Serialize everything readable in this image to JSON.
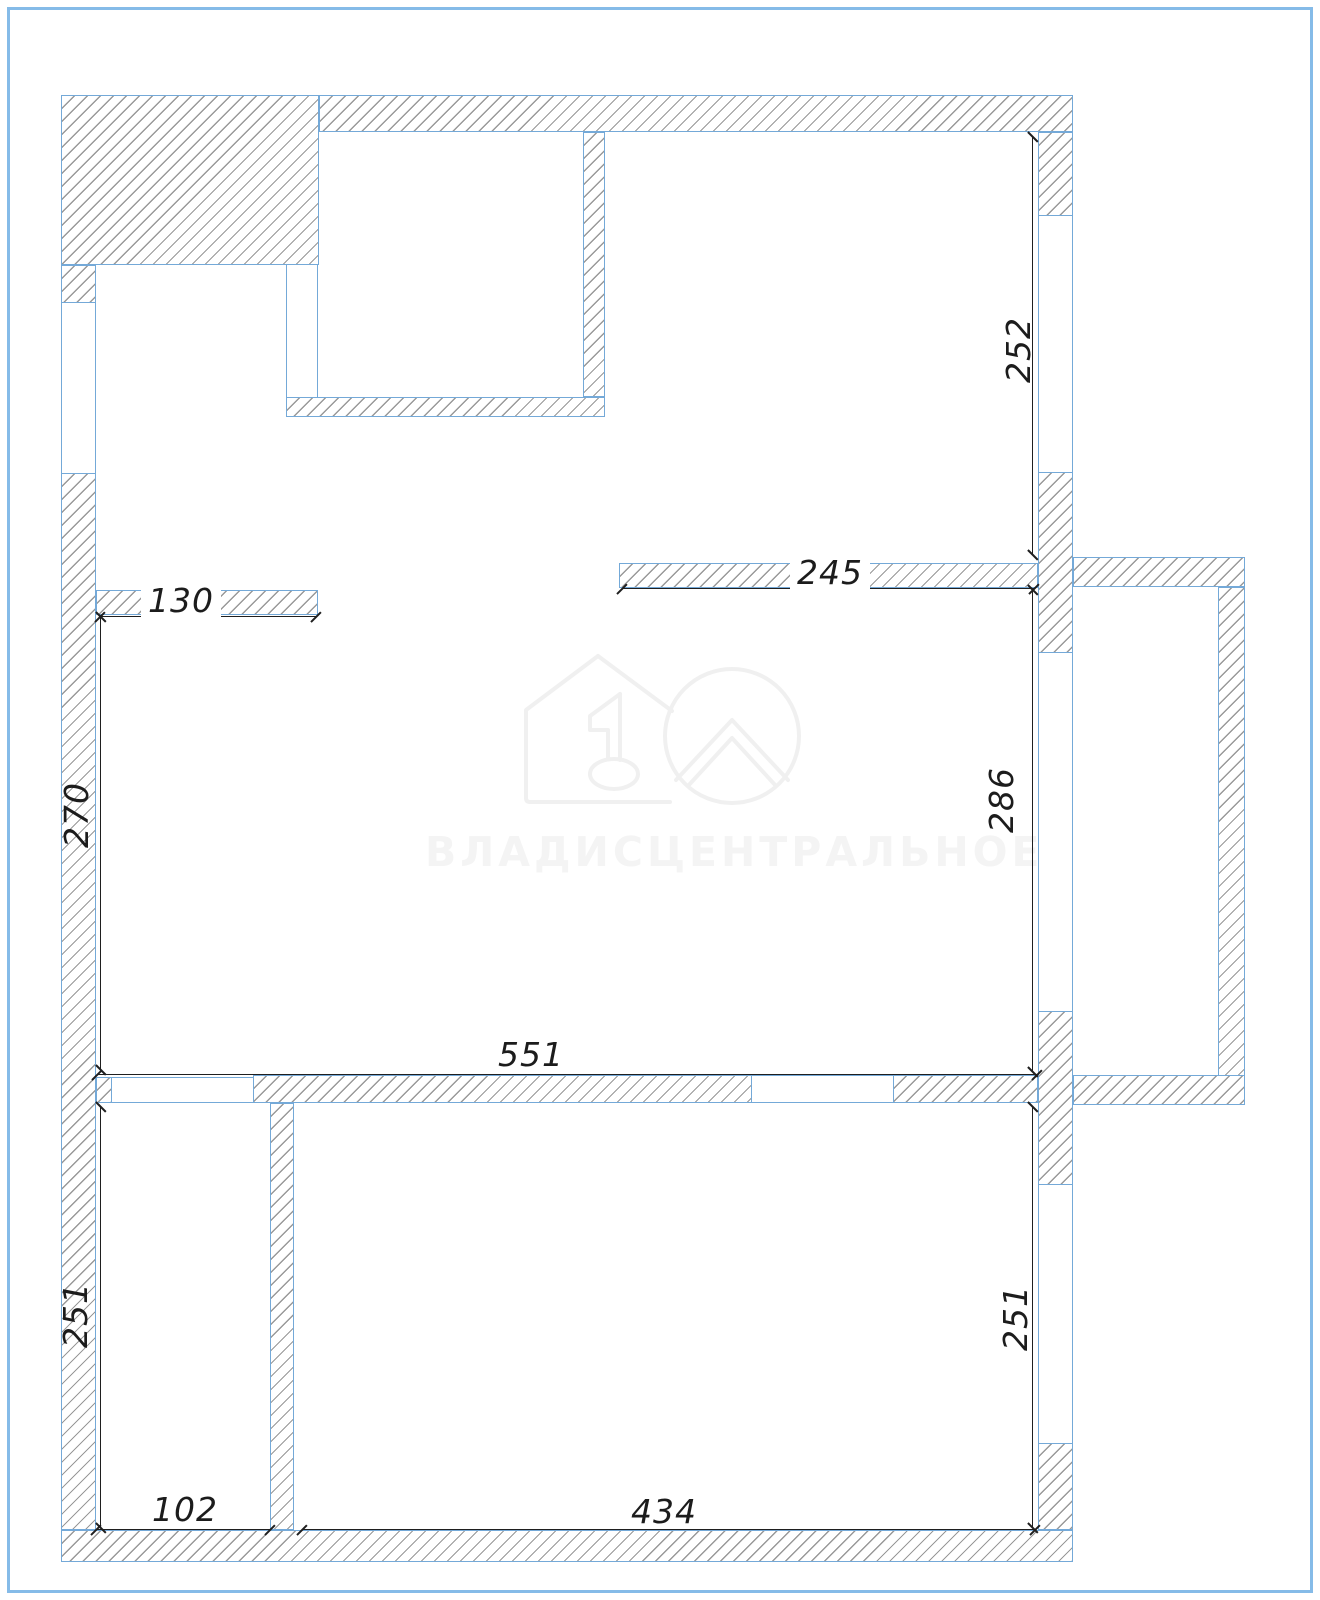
{
  "page": {
    "background": "#ffffff",
    "border_color": "#85bbe8"
  },
  "plan": {
    "type": "floor-plan",
    "wall_outline_color": "#74a9d8",
    "hatch_line_color": "#5a5a5a",
    "dimension_text_color": "#1c1c1c",
    "dimensions": {
      "upper_left_stub": "130",
      "upper_mid_wall": "245",
      "right_window_top": "252",
      "left_mid_height": "270",
      "right_mid_height": "286",
      "center_room_width": "551",
      "lower_left_height": "251",
      "lower_right_height": "251",
      "bottom_left_room_width": "102",
      "bottom_right_room_width": "434"
    }
  },
  "watermark": {
    "brand_text": "ВЛАДИСЦЕНТРАЛЬНОЕ",
    "logo": "house-number-1-circle-roof"
  }
}
